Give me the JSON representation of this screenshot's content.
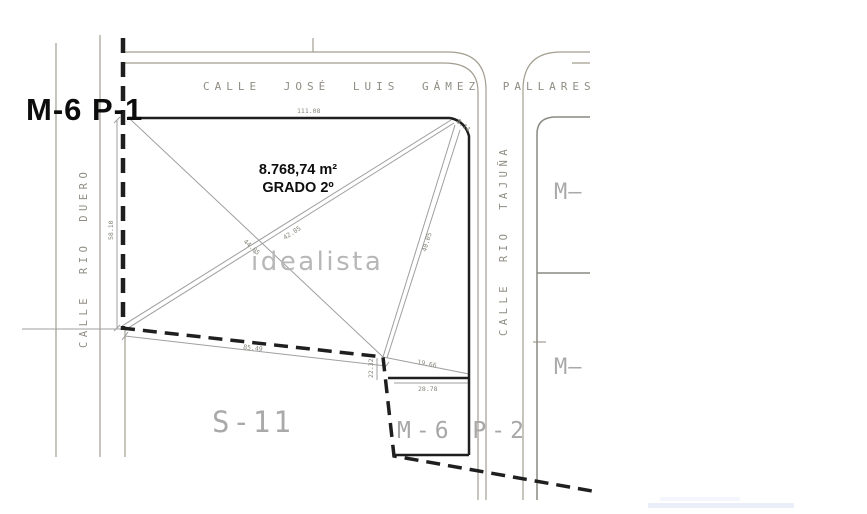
{
  "drawing": {
    "plot_label": "M-6 P-1",
    "area": "8.768,74 m²",
    "grade": "GRADO 2º",
    "watermark": "idealista",
    "sector_label": "S-11",
    "sub_plot_label": "M-6 P-2",
    "right_plot_top_label": "M—",
    "right_plot_bottom_label": "M—"
  },
  "streets": {
    "top": "CALLE JOSÉ LUIS GÁMEZ PALLARES",
    "left": "CALLE RIO DUERO",
    "right": "CALLE RIO TAJUÑA"
  },
  "dimensions": {
    "top_edge": "111.08",
    "west_edge": "58.10",
    "south_edge": "85.49",
    "diagonal_a": "44.05",
    "diagonal_b": "42.05",
    "diagonal_c": "40.05",
    "corner_chamfer": "8.14",
    "sub_plot_diagonal": "19.66",
    "sub_plot_top": "28.78",
    "junction_height": "22.32"
  },
  "colors": {
    "background": "#ffffff",
    "parcel_line_dark": "#1f1f1f",
    "street_line": "#a29e91",
    "survey_line": "#9f9f9f",
    "gray_label": "#a7a7a7",
    "watermark_gray": "#b7b7b7",
    "dimension_text": "#87877d"
  }
}
